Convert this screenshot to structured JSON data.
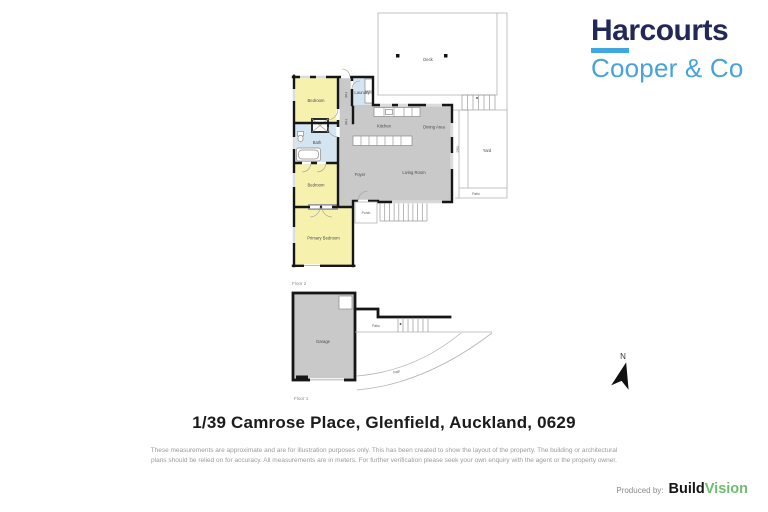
{
  "logo": {
    "title": "Harcourts",
    "subtitle": "Cooper & Co",
    "navy": "#22295a",
    "light_blue": "#47a3d9"
  },
  "plan": {
    "floor2_label": "Floor 2",
    "floor1_label": "Floor 1",
    "labels": {
      "deck": "Deck",
      "yard": "Yard",
      "yard_side": "Yard",
      "patio_upper": "Patio",
      "bedroom1": "Bedroom",
      "laundry": "Laundry",
      "hall_upper": "Hall",
      "hall_lower": "Hall",
      "bath": "Bath",
      "kitchen": "Kitchen",
      "dining": "Dining Area",
      "living": "Living Room",
      "foyer": "Foyer",
      "porch": "Porch",
      "bedroom2": "Bedroom",
      "primary": "Primary Bedroom",
      "garage": "Garage",
      "patio_lower": "Patio",
      "path": "Path"
    },
    "colors": {
      "bedroom_fill": "#f6f2ae",
      "wet_area_fill": "#d4e4f0",
      "floor_fill": "#c9c9c9",
      "wall": "#161616",
      "outdoor_outline": "#b3b3b3"
    }
  },
  "compass": {
    "n": "N"
  },
  "address": "1/39 Camrose Place, Glenfield, Auckland, 0629",
  "disclaimer": {
    "line1": "These measurements are approximate and are for illustration purposes only. This has been created to show the layout of the property. The building or architectural",
    "line2": "plans should be relied on for accuracy. All measurements are in meters. For further verification please seek your own enquiry with the agent or the property owner."
  },
  "producer": {
    "label": "Produced by:",
    "brand_a": "Build",
    "brand_b": "Vision",
    "green": "#6dbd6f"
  }
}
